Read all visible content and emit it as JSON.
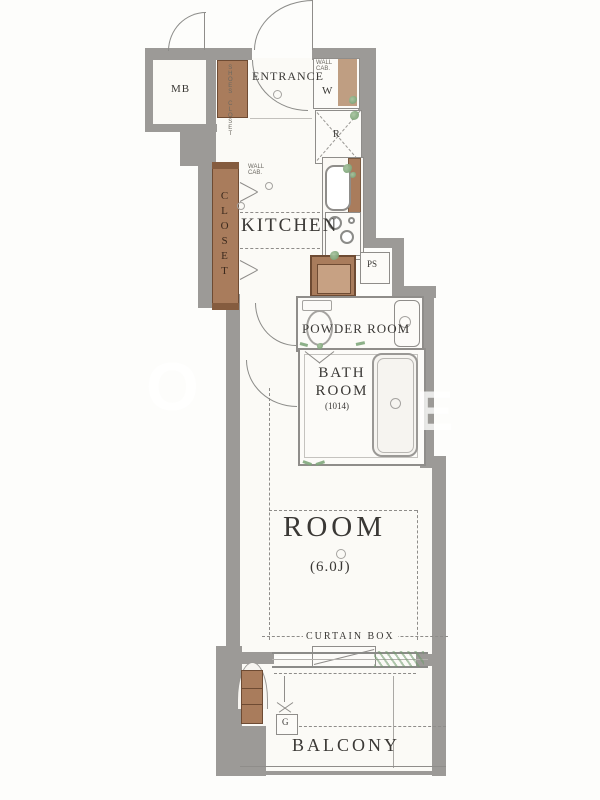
{
  "type": "apartment-floor-plan",
  "labels": {
    "mb": "MB",
    "entrance": "ENTRANCE",
    "shoes_closet": "SHOES CLOSET",
    "kitchen": "KITCHEN",
    "closet": "CLOSET",
    "wall_cabinet": "WALL CAB.",
    "washer": "W",
    "fridge": "R",
    "ps": "PS",
    "counter": "COUNTER",
    "powder_room": "POWDER ROOM",
    "bath_line1": "BATH",
    "bath_line2": "ROOM",
    "bath_size": "(1014)",
    "room": "ROOM",
    "room_size": "(6.0J)",
    "curtain_box": "CURTAIN BOX",
    "balcony": "BALCONY",
    "gas_meter": "G"
  },
  "watermark": {
    "left": "O",
    "right": "E"
  },
  "colors": {
    "wall": "#9c9a97",
    "wood": "#a97c5c",
    "wood_dark": "#6e4b33",
    "accent_green": "#6f9a6b",
    "line": "#8b8b88",
    "text": "#3a3835"
  }
}
